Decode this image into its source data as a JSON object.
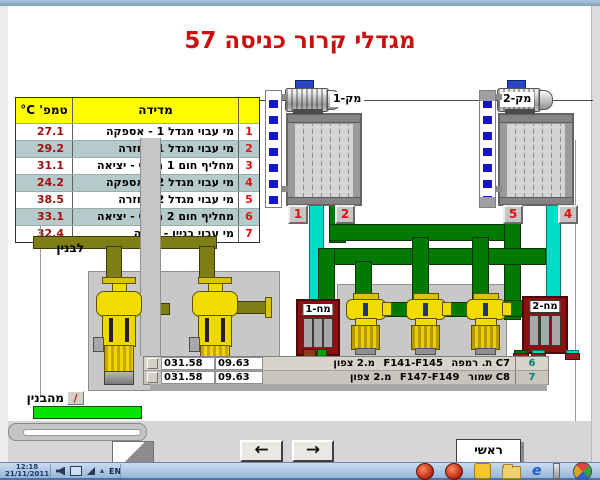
{
  "title": "מגדלי קרור כניסה 57",
  "table": {
    "header": {
      "temp": "טמפ' C°",
      "measurement": "מדידה"
    },
    "rows": [
      {
        "num": "1",
        "label": "מי עבוי מגדל 1 - אספקה",
        "temp": "27.1"
      },
      {
        "num": "2",
        "label": "מי עבוי מגדל 1 - חזרה",
        "temp": "29.2"
      },
      {
        "num": "3",
        "label": "מחליף חום 1 משני - יציאה",
        "temp": "31.1"
      },
      {
        "num": "4",
        "label": "מי עבוי מגדל 2 - אספקה",
        "temp": "24.2"
      },
      {
        "num": "5",
        "label": "מי עבוי מגדל 2 - חזרה",
        "temp": "38.5"
      },
      {
        "num": "6",
        "label": "מחליף חום 2 משני - יציאה",
        "temp": "33.1"
      },
      {
        "num": "7",
        "label": "מי עבוי בניין - חזרה",
        "temp": "32.4"
      }
    ]
  },
  "diagram": {
    "tower1_label": "מק-1",
    "tower2_label": "מק-2",
    "hx1_label": "מח-1",
    "hx2_label": "מח-2",
    "to_building": "לבנין",
    "from_building": "מהבנין",
    "slash_button": "/",
    "pipe_boxes": {
      "b1": "1",
      "b2": "2",
      "b4": "4",
      "b5": "5"
    }
  },
  "readout": {
    "rows": [
      {
        "flow": "031.58",
        "pressure": "09.63",
        "unit": "C7 ת. רמפה",
        "range": "F141-F145",
        "location": "מ.2 צפון",
        "num": "6"
      },
      {
        "flow": "031.58",
        "pressure": "09.63",
        "unit": "C8 שמור",
        "range": "F147-F149",
        "location": "מ.2 צפון",
        "num": "7"
      }
    ]
  },
  "nav": {
    "back": "←",
    "forward": "→",
    "main": "ראשי"
  },
  "taskbar": {
    "time": "12:18",
    "date": "21/11/2011",
    "lang": "EN"
  },
  "colors": {
    "accent_red": "#cc1010",
    "pipe_green": "#007a00",
    "pipe_cyan": "#00dcc8",
    "pipe_olive": "#7e7e14",
    "hx_red": "#8b1010",
    "table_header_yellow": "#ffff00",
    "row_shade": "#b5cbcb"
  }
}
